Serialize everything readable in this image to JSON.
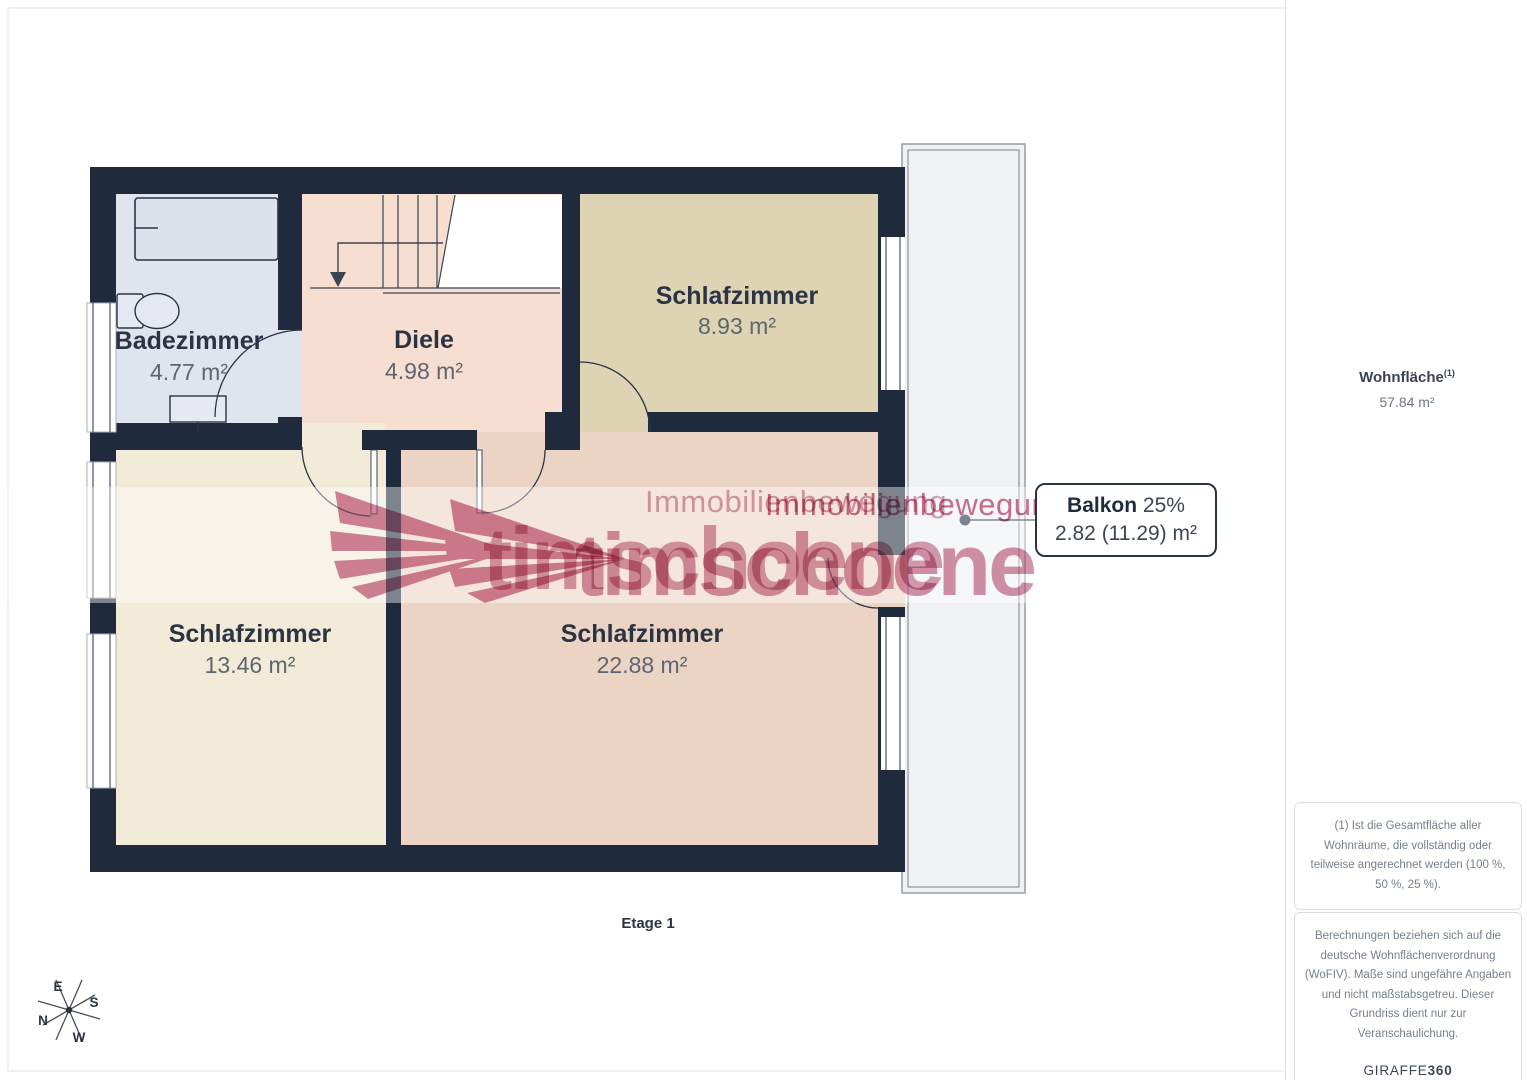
{
  "floor_label": "Etage 1",
  "rooms": [
    {
      "name": "Badezimmer",
      "area": "4.77 m²"
    },
    {
      "name": "Diele",
      "area": "4.98 m²"
    },
    {
      "name": "Schlafzimmer",
      "area": "8.93 m²"
    },
    {
      "name": "Schlafzimmer",
      "area": "13.46 m²"
    },
    {
      "name": "Schlafzimmer",
      "area": "22.88 m²"
    }
  ],
  "balcony_callout": {
    "name": "Balkon",
    "percent": "25%",
    "area": "2.82 (11.29) m²"
  },
  "sidebar": {
    "total_label": "Wohnfläche",
    "total_sup": "(1)",
    "total_area": "57.84 m²",
    "footnote1": "(1) Ist die Gesamtfläche aller Wohnräume, die vollständig oder teilweise angerechnet werden (100 %, 50 %, 25 %).",
    "footnote2": "Berechnungen beziehen sich auf die deutsche Wohnflächenverordnung (WoFIV). Maße sind ungefähre Angaben und nicht maßstabsgetreu. Dieser Grundriss dient nur zur Veranschaulichung.",
    "brand": "GIRAFFE",
    "brand_bold": "360"
  },
  "watermark": {
    "line1": "Immobilienbewegung",
    "line2": "timschoene"
  },
  "compass": {
    "e": "E",
    "s": "S",
    "n": "N",
    "w": "W"
  },
  "colors": {
    "wall": "#1f2b3d",
    "badezimmer_floor": "#e0e4ef",
    "diele_floor": "#f6ded1",
    "schlafzimmer_893_floor": "#ded3b2",
    "schlafzimmer_1346_floor": "#f1ebd7",
    "schlafzimmer_2288_floor": "#ecd4c5",
    "balcony_floor": "#f0f1f3",
    "watermark_pink": "#c25578"
  }
}
